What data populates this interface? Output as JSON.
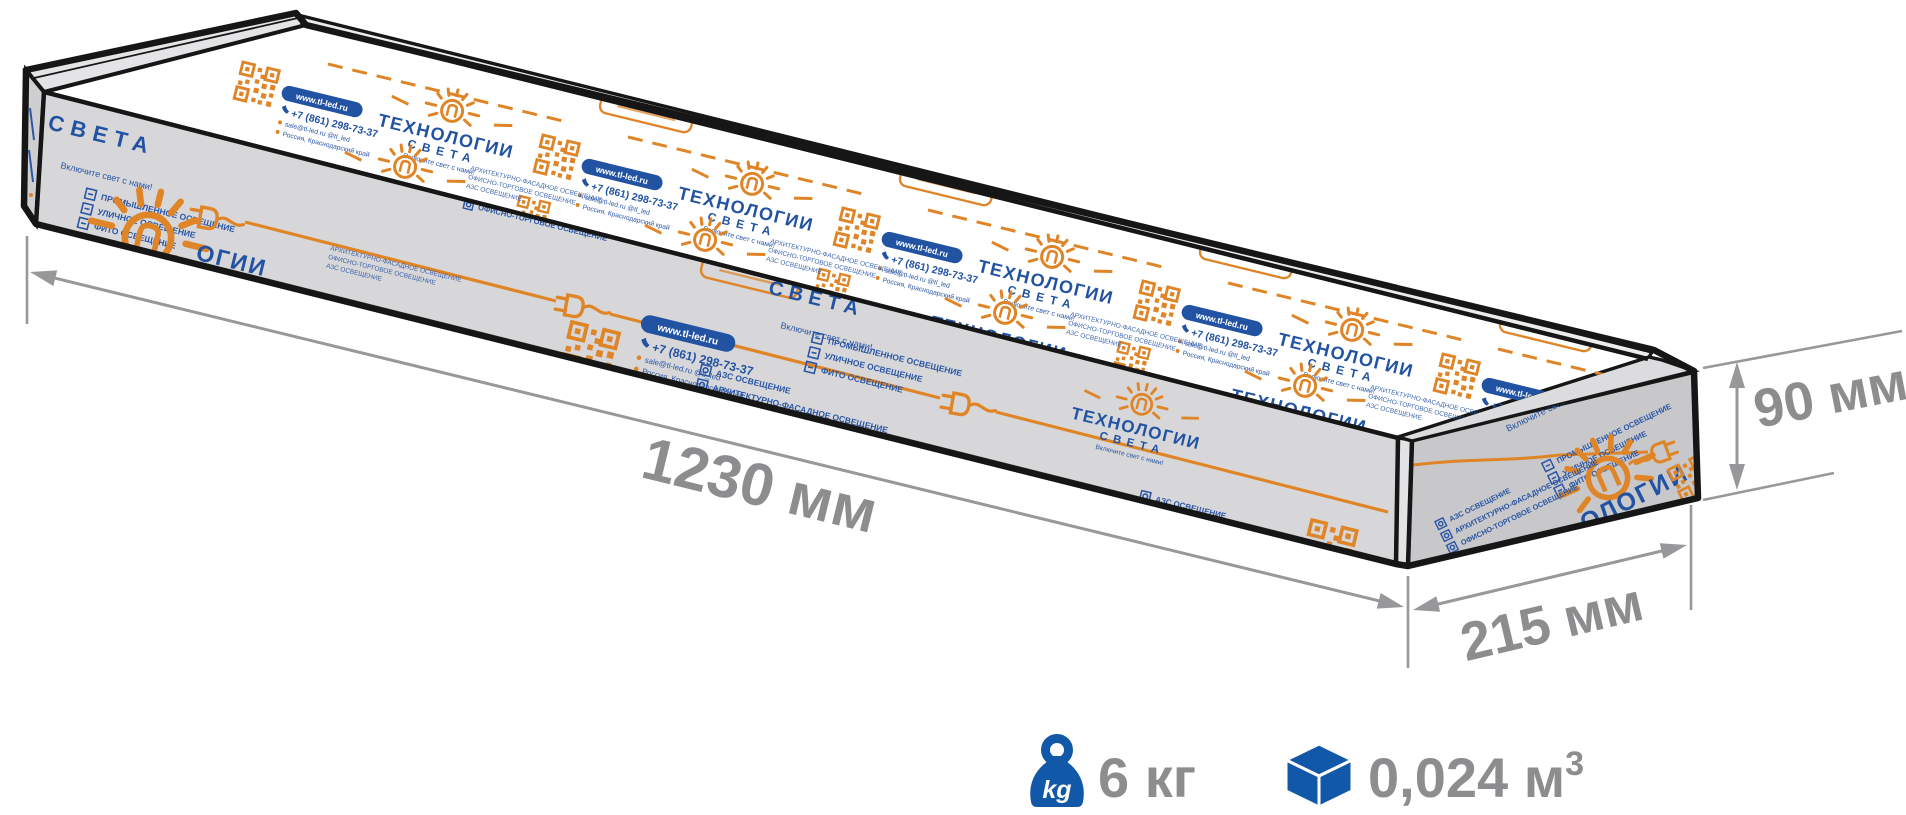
{
  "diagram": {
    "length_label": "1230 мм",
    "width_label": "215 мм",
    "height_label": "90 мм",
    "weight_label": "6 кг",
    "weight_icon_text": "kg",
    "volume_label": "0,024 м",
    "volume_superscript": "3",
    "colors": {
      "icon_blue": "#1159a8",
      "brand_orange": "#df8527",
      "brand_blue": "#2253a3",
      "dimension_gray": "#98989a",
      "label_gray": "#8d8d8f",
      "front_face": "#d7d7d9",
      "end_face": "#c8c8cb",
      "outline": "#161616"
    }
  },
  "packaging": {
    "brand_title": "ТЕХНОЛОГИИ",
    "brand_subtitle": "СВЕТА",
    "tagline": "Включите свет с нами!",
    "website": "www.tl-led.ru",
    "phone": "+7 (861) 298-73-37",
    "contact_line": "sale@tl-led.ru  @tl_led",
    "address_line": "Россия, Краснодарский край",
    "osram_label": "OSRAM",
    "services_a": [
      "ПРОМЫШЛЕННОЕ ОСВЕЩЕНИЕ",
      "УЛИЧНОЕ ОСВЕЩЕНИЕ",
      "ФИТО ОСВЕЩЕНИЕ"
    ],
    "services_b": [
      "АЗС ОСВЕЩЕНИЕ",
      "АРХИТЕКТУРНО-ФАСАДНОЕ ОСВЕЩЕНИЕ",
      "ОФИСНО-ТОРГОВОЕ ОСВЕЩЕНИЕ"
    ],
    "title_fragment_front": "ОГИИ",
    "title_fragment_end": "ОЛОГИИ"
  }
}
